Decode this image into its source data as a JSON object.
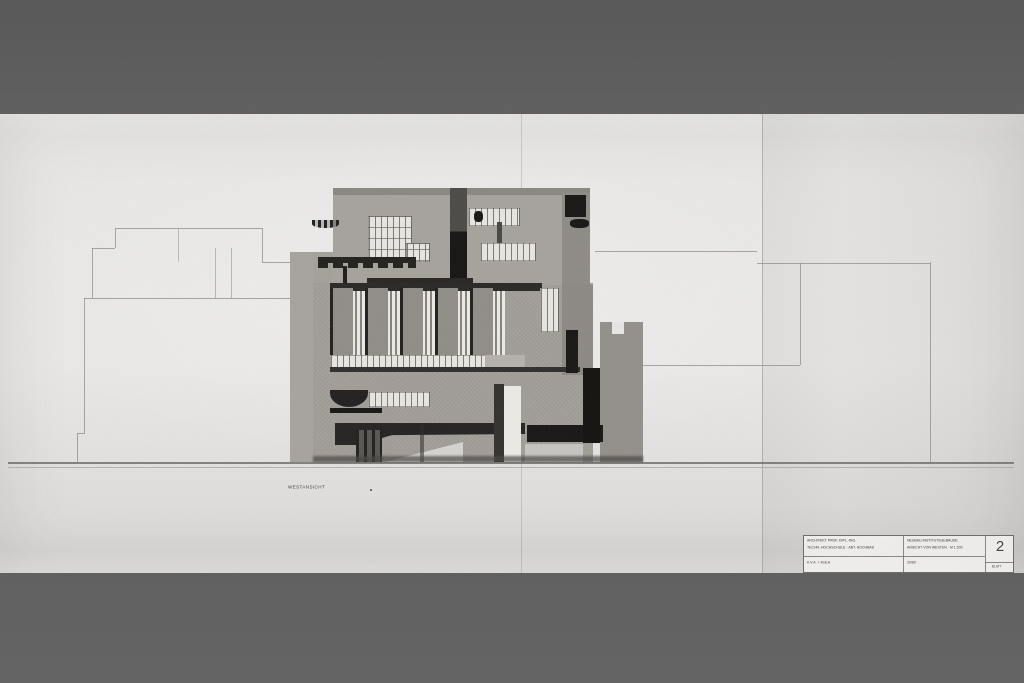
{
  "drawing": {
    "label": "WESTANSICHT"
  },
  "titleblock": {
    "left_line1": "ARCHITEKT PROF. DIPL.-ING.",
    "left_line2": "TECHN. HOCHSCHULE · ABT. HOCHBAU",
    "mid_line1": "NEUBAU INSTITUTSGEBÄUDE",
    "mid_line2": "ANSICHT VON WESTEN · M 1:200",
    "bottom_left": "K.V.A. + M.B.A.",
    "bottom_mid": "20/60",
    "sheet_number": "2",
    "sheet_caption": "BLATT"
  },
  "colors": {
    "letterbox": "#5c5c5c",
    "paper": "#e9e8e6",
    "wash_gray": "#a09c96",
    "ink_black": "#141311",
    "outline_gray": "#8e8b86",
    "window_white": "#e8e6e1"
  }
}
